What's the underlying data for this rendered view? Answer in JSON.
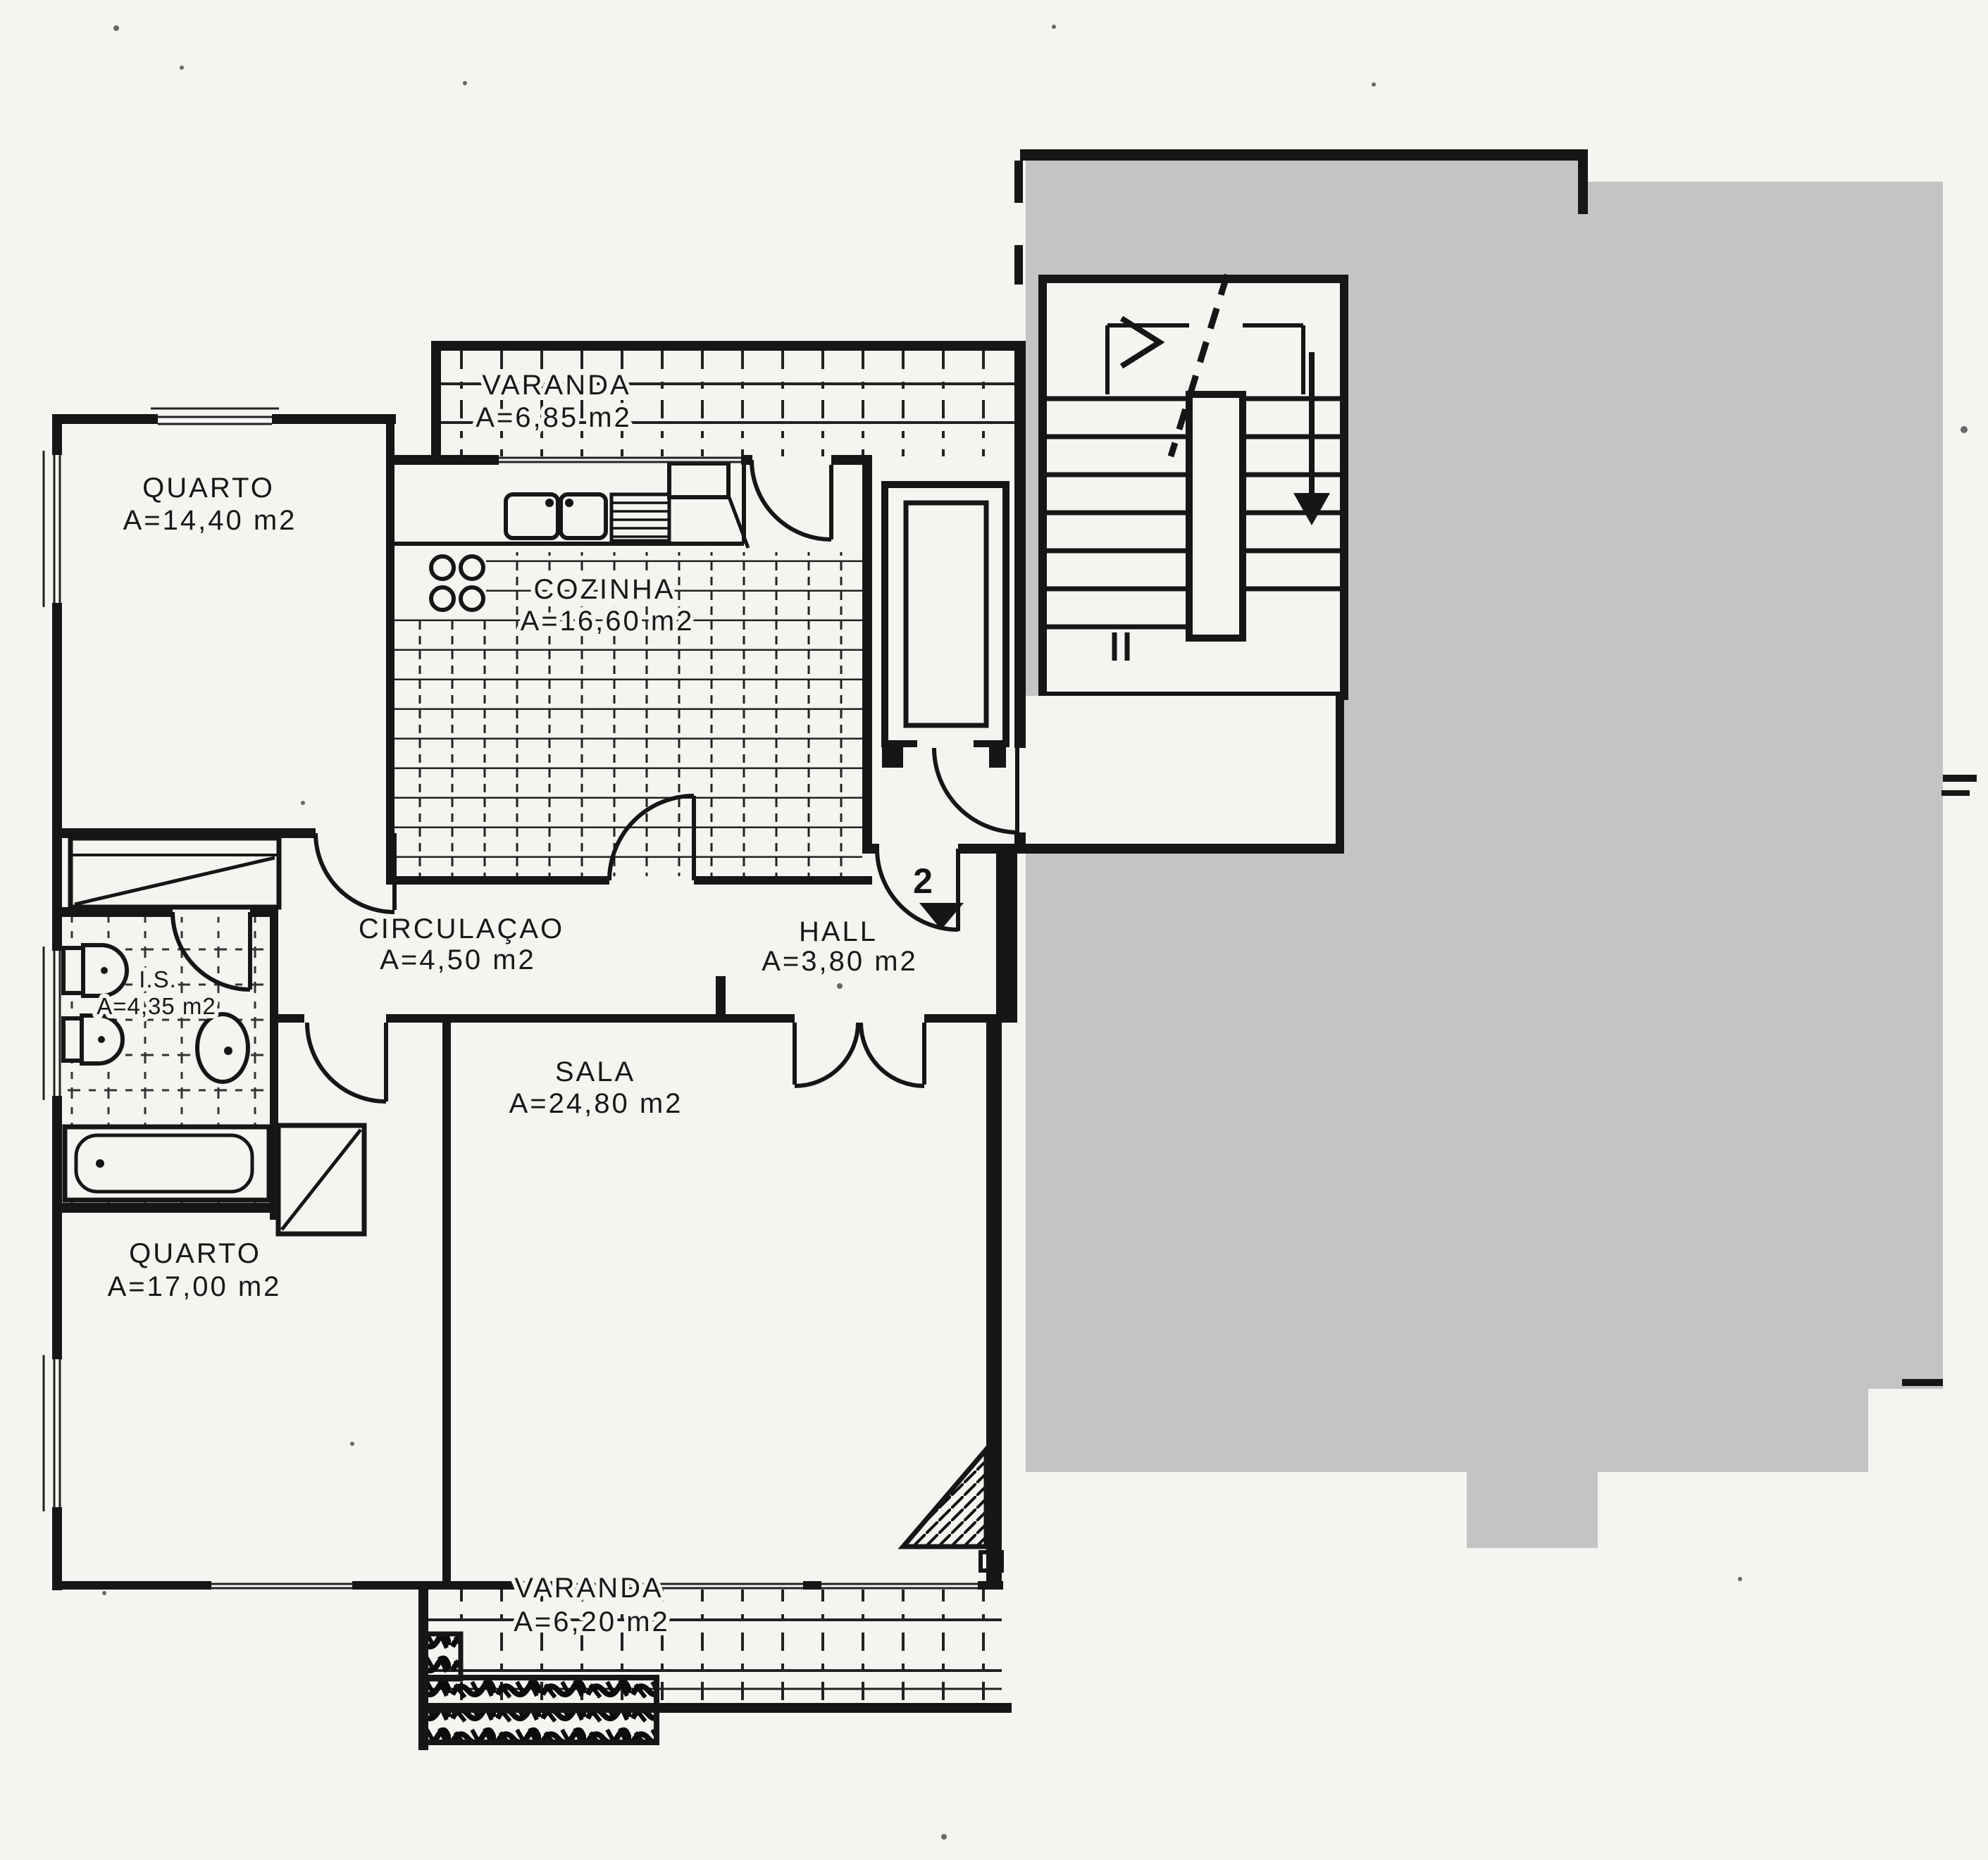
{
  "document": {
    "kind": "scanned apartment floor plan",
    "paper_color": "#f5f4f1",
    "ink_color": "#161616",
    "mask_color": "#c4c4c4"
  },
  "rooms": [
    {
      "id": "varanda-top",
      "name": "VARANDA",
      "area": "A=6,85  m2"
    },
    {
      "id": "quarto-1",
      "name": "QUARTO",
      "area": "A=14,40  m2"
    },
    {
      "id": "cozinha",
      "name": "COZINHA",
      "area": "A=16,60  m2"
    },
    {
      "id": "circulacao",
      "name": "CIRCULAÇAO",
      "area": "A=4,50  m2"
    },
    {
      "id": "hall",
      "name": "HALL",
      "area": "A=3,80  m2"
    },
    {
      "id": "instalacao-sanitaria",
      "name": "I.S.",
      "area": "A=4,35 m2"
    },
    {
      "id": "sala",
      "name": "SALA",
      "area": "A=24,80  m2"
    },
    {
      "id": "quarto-2",
      "name": "QUARTO",
      "area": "A=17,00  m2"
    },
    {
      "id": "varanda-bottom",
      "name": "VARANDA",
      "area": "A=6,20  m2"
    }
  ],
  "markers": {
    "apartment_number": "2"
  }
}
